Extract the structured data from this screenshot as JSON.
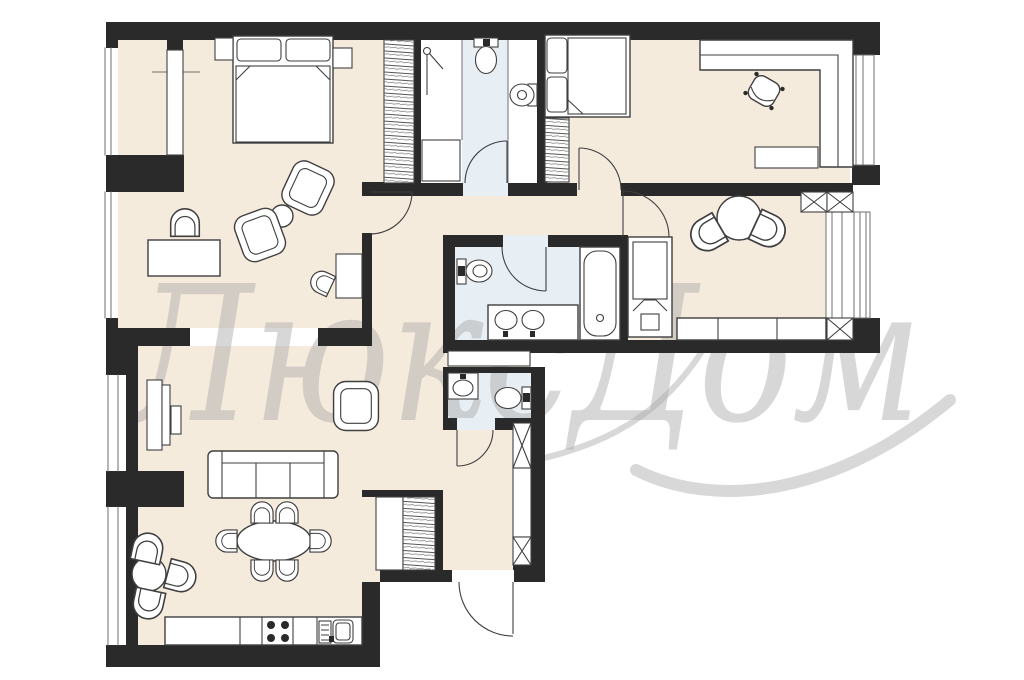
{
  "watermark": {
    "text": "ЛюксДом"
  },
  "palette": {
    "bg": "#ffffff",
    "floor": "#f5ebdd",
    "wet_floor": "#e7eef4",
    "wall": "#2a2a2a",
    "line": "#3f3f3f",
    "thin": "#6f6f6f",
    "watermark": "#a8a8a8"
  },
  "plan": {
    "type": "apartment-floor-plan",
    "rooms": [
      {
        "name": "bedroom-1",
        "furniture": [
          "double-bed",
          "nightstand-left",
          "nightstand-right",
          "built-in-wardrobe",
          "shelf-unit",
          "desk",
          "desk-chair",
          "armchair",
          "armchair",
          "round-side-table",
          "small-chair",
          "side-table"
        ]
      },
      {
        "name": "shower-room",
        "fixtures": [
          "shower-head",
          "shower-tray",
          "wall-hung-toilet",
          "round-washbasin"
        ]
      },
      {
        "name": "bedroom-2",
        "furniture": [
          "double-bed",
          "built-in-wardrobe",
          "corner-desk",
          "office-chair",
          "low-cabinet"
        ]
      },
      {
        "name": "kitchen-dining-room",
        "furniture": [
          "round-table",
          "tub-chair",
          "tub-chair",
          "kitchen-counter",
          "tall-cabinet"
        ],
        "shafts": 3
      },
      {
        "name": "bathroom",
        "fixtures": [
          "toilet",
          "double-sink-vanity",
          "bathtub"
        ]
      },
      {
        "name": "wc",
        "fixtures": [
          "washbasin",
          "toilet"
        ]
      },
      {
        "name": "hallway",
        "furniture": [
          "console-cabinet",
          "closet",
          "hatched-wardrobe"
        ],
        "shafts": 2
      },
      {
        "name": "living-room-kitchen",
        "furniture": [
          "tv-console",
          "tv",
          "armchair",
          "sofa",
          "oval-dining-table",
          "six-chairs",
          "small-round-table",
          "three-chairs",
          "kitchen-counter",
          "cooktop",
          "dishwasher",
          "sink"
        ]
      }
    ],
    "doors": [
      "bedroom-1-door",
      "shower-room-door",
      "bedroom-2-door",
      "kitchen-door",
      "bathroom-door",
      "wc-door",
      "entrance-door"
    ],
    "windows": [
      "bedroom-1-window-upper",
      "bedroom-1-window-lower",
      "living-room-window-upper",
      "living-room-window-lower",
      "bedroom-2-window-east",
      "kitchen-window-east"
    ]
  }
}
